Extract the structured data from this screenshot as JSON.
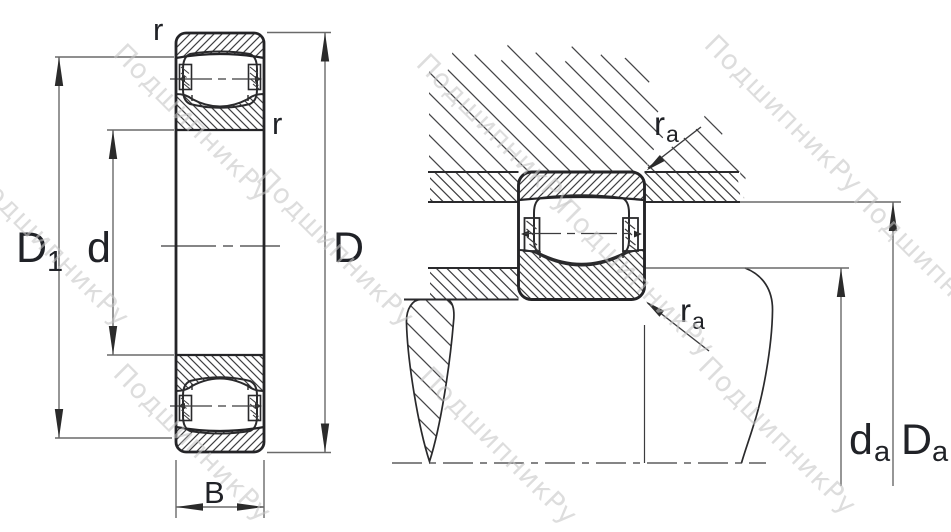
{
  "watermark": {
    "text": "ПодшипникРу"
  },
  "left_view": {
    "dims": {
      "D1": {
        "main": "D",
        "sub": "1"
      },
      "d": {
        "main": "d"
      },
      "D": {
        "main": "D"
      },
      "B": {
        "main": "B"
      },
      "r_top": {
        "main": "r"
      },
      "r_inner": {
        "main": "r"
      }
    }
  },
  "right_view": {
    "dims": {
      "ra_top": {
        "main": "r",
        "sub": "a"
      },
      "ra_bottom": {
        "main": "r",
        "sub": "a"
      },
      "da": {
        "main": "d",
        "sub": "a"
      },
      "Da": {
        "main": "D",
        "sub": "a"
      }
    }
  }
}
